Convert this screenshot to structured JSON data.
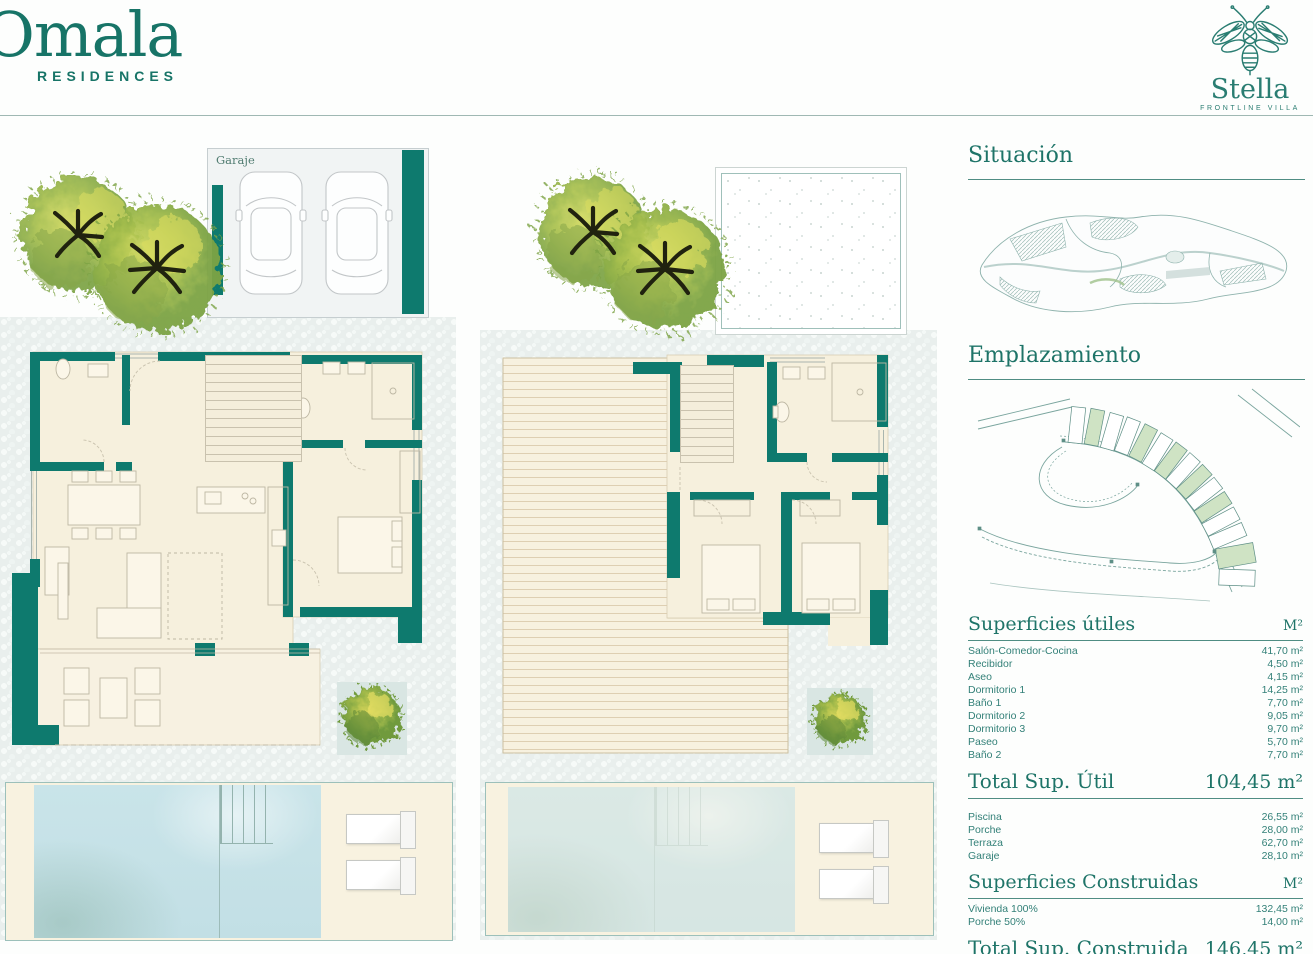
{
  "header": {
    "brand_name": "Omala",
    "brand_subtitle": "RESIDENCES",
    "villa_name": "Stella",
    "villa_subtitle": "FRONTLINE VILLA"
  },
  "plans": {
    "ground": {
      "garaje": "Garaje",
      "aseo": "Aseo",
      "recibidor": "Recibidor",
      "bano1": "Baño 1",
      "salon": "Salón / Comedor / Cocina",
      "dormitorio1": "Dormitorio 1",
      "porche": "Porche"
    },
    "first": {
      "terraza": "Terraza",
      "bano2": "Baño 2",
      "paso": "Paso",
      "dormitorio3": "Dormitorio 3",
      "dormitorio2": "Dormitorio 2"
    }
  },
  "sidebar": {
    "situacion_title": "Situación",
    "emplazamiento_title": "Emplazamiento",
    "superficies_utiles": {
      "title": "Superficies útiles",
      "unit": "M²",
      "rows": [
        {
          "label": "Salón-Comedor-Cocina",
          "value": "41,70 m²"
        },
        {
          "label": "Recibidor",
          "value": "4,50 m²"
        },
        {
          "label": "Aseo",
          "value": "4,15 m²"
        },
        {
          "label": "Dormitorio 1",
          "value": "14,25 m²"
        },
        {
          "label": "Baño 1",
          "value": "7,70 m²"
        },
        {
          "label": "Dormitorio 2",
          "value": "9,05 m²"
        },
        {
          "label": "Dormitorio 3",
          "value": "9,70 m²"
        },
        {
          "label": "Paseo",
          "value": "5,70 m²"
        },
        {
          "label": "Baño 2",
          "value": "7,70 m²"
        }
      ],
      "total_label": "Total Sup. Útil",
      "total_value": "104,45 m²"
    },
    "exterior_rows": [
      {
        "label": "Piscina",
        "value": "26,55 m²"
      },
      {
        "label": "Porche",
        "value": "28,00 m²"
      },
      {
        "label": "Terraza",
        "value": "62,70 m²"
      },
      {
        "label": "Garaje",
        "value": "28,10 m²"
      }
    ],
    "superficies_construidas": {
      "title": "Superficies Construidas",
      "unit": "M²",
      "rows": [
        {
          "label": "Vivienda 100%",
          "value": "132,45 m²"
        },
        {
          "label": "Porche 50%",
          "value": "14,00 m²"
        }
      ],
      "total_label": "Total Sup. Construida",
      "total_value": "146,45 m²"
    }
  },
  "colors": {
    "wall_teal": "#0e7a6e",
    "text_teal": "#1e7468",
    "cream": "#f6f0dd",
    "pool_blue": "#c9e4e9",
    "plot_green": "#cfe3c4",
    "leaf_green": "#a8c04d"
  }
}
